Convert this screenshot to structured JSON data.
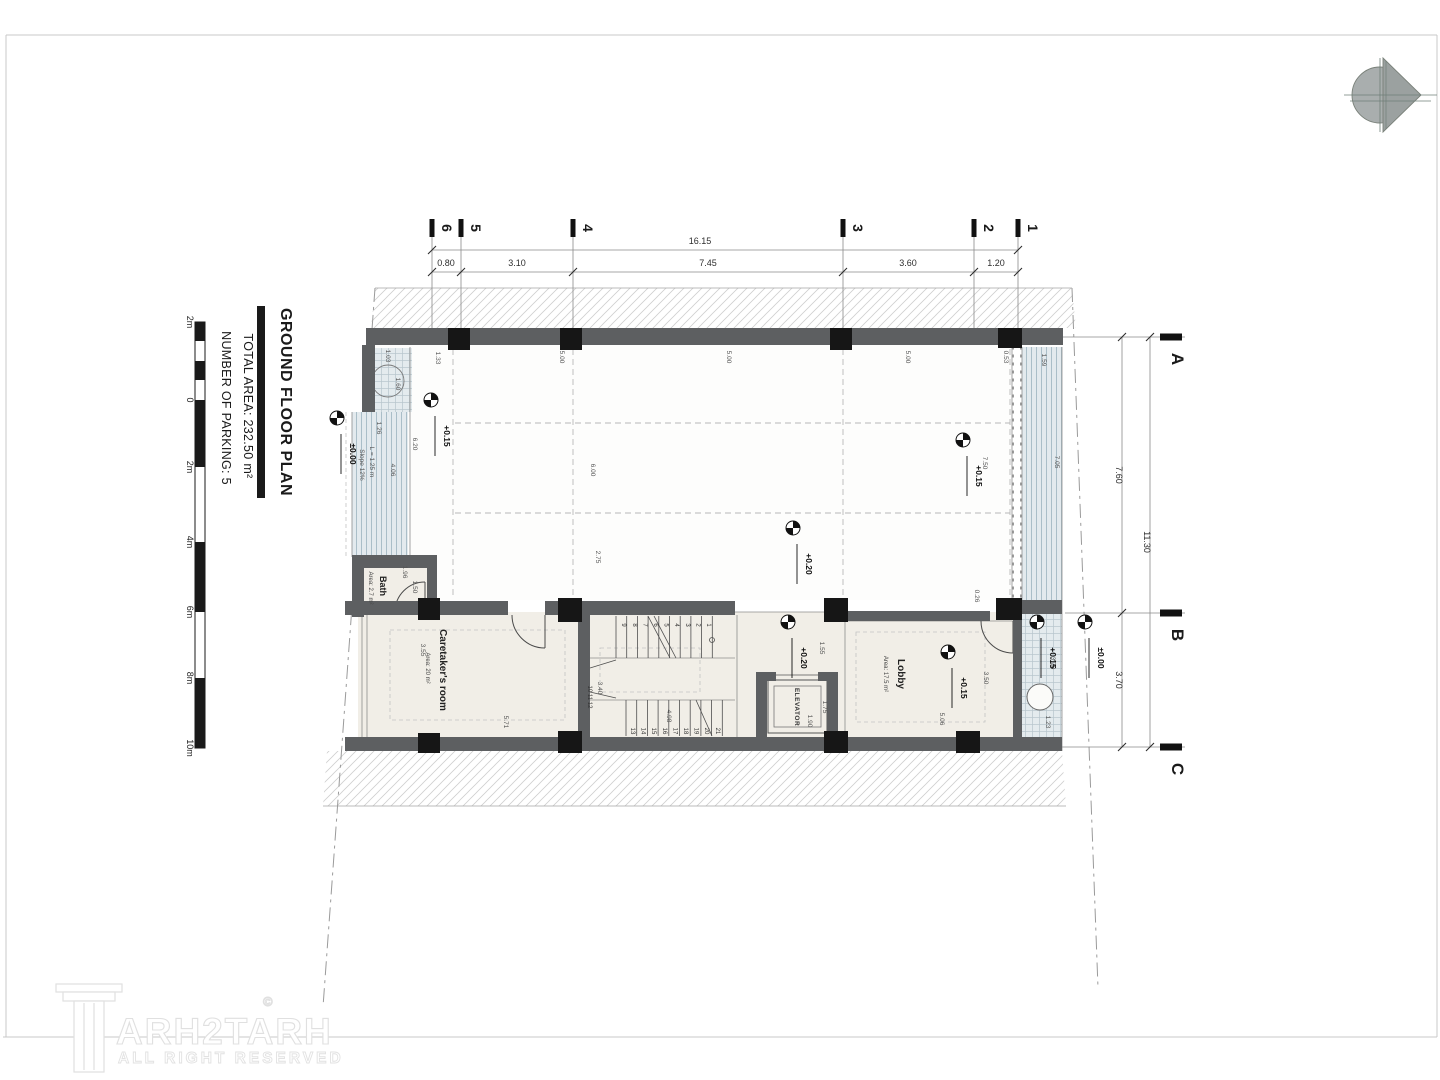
{
  "sheet": {
    "title": "GROUND FLOOR PLAN",
    "total_area": "TOTAL AREA: 232.50 m²",
    "parking_count": "NUMBER OF PARKING: 5"
  },
  "scale_bar": {
    "labels": [
      {
        "t": "2m",
        "y": 322
      },
      {
        "t": "0",
        "y": 400
      },
      {
        "t": "2m",
        "y": 467
      },
      {
        "t": "4m",
        "y": 542
      },
      {
        "t": "6m",
        "y": 612
      },
      {
        "t": "8m",
        "y": 678
      },
      {
        "t": "10m",
        "y": 748
      }
    ]
  },
  "grid": {
    "cols": [
      {
        "l": "6",
        "x": 432
      },
      {
        "l": "5",
        "x": 461
      },
      {
        "l": "4",
        "x": 573
      },
      {
        "l": "3",
        "x": 843
      },
      {
        "l": "2",
        "x": 974
      },
      {
        "l": "1",
        "x": 1018
      }
    ],
    "rows": [
      {
        "l": "A",
        "y": 337
      },
      {
        "l": "B",
        "y": 613
      },
      {
        "l": "C",
        "y": 747
      }
    ],
    "dims_top": {
      "total": {
        "t": "16.15",
        "x": 700,
        "y": 244
      },
      "segments": [
        {
          "t": "0.80",
          "x": 446
        },
        {
          "t": "3.10",
          "x": 517
        },
        {
          "t": "7.45",
          "x": 708
        },
        {
          "t": "3.60",
          "x": 908
        },
        {
          "t": "1.20",
          "x": 996
        }
      ]
    },
    "dims_right": {
      "total": {
        "t": "11.30",
        "y": 542
      },
      "segments": [
        {
          "t": "7.60",
          "y": 475
        },
        {
          "t": "3.70",
          "y": 680
        }
      ]
    }
  },
  "rooms": {
    "bath": {
      "name": "Bath",
      "area": "Area: 2.7 m²"
    },
    "caretaker": {
      "name": "Caretaker's room",
      "area": "Area: 20 m²"
    },
    "lobby": {
      "name": "Lobby",
      "area": "Area: 17.5 m²"
    },
    "elevator": {
      "name": "ELEVATOR"
    },
    "ramp": {
      "line1": "L = 1.25 m",
      "line2": "Slope 12%"
    }
  },
  "levels": [
    {
      "t": "±0.00",
      "x": 337,
      "y": 418
    },
    {
      "t": "+0.15",
      "x": 431,
      "y": 400
    },
    {
      "t": "+0.20",
      "x": 793,
      "y": 528
    },
    {
      "t": "+0.15",
      "x": 963,
      "y": 440
    },
    {
      "t": "+0.20",
      "x": 788,
      "y": 622
    },
    {
      "t": "+0.15",
      "x": 948,
      "y": 652
    },
    {
      "t": "+0.15",
      "x": 1037,
      "y": 622
    },
    {
      "t": "±0.00",
      "x": 1085,
      "y": 622
    }
  ],
  "dims_small": [
    {
      "t": "1.03",
      "x": 386,
      "y": 356
    },
    {
      "t": "1.33",
      "x": 436,
      "y": 358
    },
    {
      "t": "5.00",
      "x": 560,
      "y": 357
    },
    {
      "t": "5.00",
      "x": 727,
      "y": 357
    },
    {
      "t": "5.00",
      "x": 906,
      "y": 357
    },
    {
      "t": "0.53",
      "x": 1004,
      "y": 357
    },
    {
      "t": "1.59",
      "x": 1042,
      "y": 360
    },
    {
      "t": "1.26",
      "x": 377,
      "y": 428
    },
    {
      "t": "6.20",
      "x": 413,
      "y": 444
    },
    {
      "t": "4.06",
      "x": 391,
      "y": 470
    },
    {
      "t": "6.00",
      "x": 591,
      "y": 470
    },
    {
      "t": "2.75",
      "x": 596,
      "y": 557
    },
    {
      "t": "7.50",
      "x": 983,
      "y": 463
    },
    {
      "t": "0.26",
      "x": 975,
      "y": 596
    },
    {
      "t": "7.05",
      "x": 1055,
      "y": 462
    },
    {
      "t": "1.60",
      "x": 396,
      "y": 384
    },
    {
      "t": "1.96",
      "x": 403,
      "y": 572
    },
    {
      "t": "1.50",
      "x": 413,
      "y": 587
    },
    {
      "t": "3.55",
      "x": 421,
      "y": 650
    },
    {
      "t": "5.71",
      "x": 504,
      "y": 722
    },
    {
      "t": "3.40",
      "x": 598,
      "y": 688
    },
    {
      "t": "4.98",
      "x": 667,
      "y": 716
    },
    {
      "t": "1.55",
      "x": 820,
      "y": 648
    },
    {
      "t": "1.75",
      "x": 823,
      "y": 707
    },
    {
      "t": "1.90",
      "x": 808,
      "y": 721
    },
    {
      "t": "3.50",
      "x": 984,
      "y": 678
    },
    {
      "t": "5.06",
      "x": 940,
      "y": 719
    },
    {
      "t": "3.70",
      "x": 1051,
      "y": 663
    },
    {
      "t": "1.23",
      "x": 1046,
      "y": 722
    }
  ],
  "stairs": {
    "top_nums": [
      "1",
      "2",
      "3",
      "4",
      "5",
      "6",
      "7",
      "8",
      "9"
    ],
    "mid_nums": "10 11 12",
    "bottom_nums": [
      "13",
      "14",
      "15",
      "16",
      "17",
      "18",
      "19",
      "20",
      "21"
    ]
  },
  "logo": {
    "text": "ARH2TARH",
    "mark": "©",
    "subtext": "ALL RIGHT RESERVED"
  }
}
